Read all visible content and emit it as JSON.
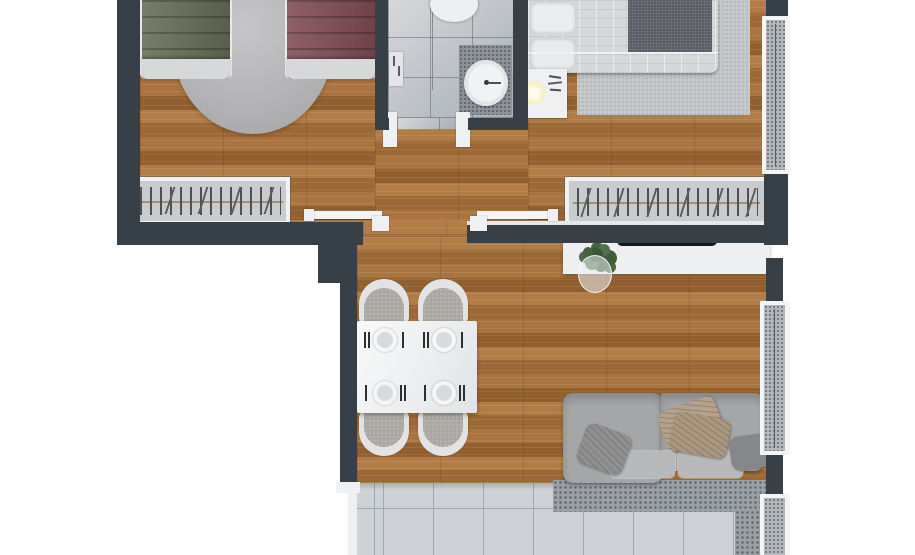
{
  "scene": {
    "type": "floor-plan-3d-top-view",
    "rooms": [
      {
        "name": "twin-bedroom",
        "position": "top-left"
      },
      {
        "name": "bathroom",
        "position": "top-center"
      },
      {
        "name": "master-bedroom",
        "position": "top-right"
      },
      {
        "name": "hallway",
        "position": "center"
      },
      {
        "name": "living-dining-room",
        "position": "bottom-center"
      },
      {
        "name": "tiled-balcony",
        "position": "bottom"
      }
    ],
    "furniture": [
      "single-bed-green",
      "single-bed-maroon",
      "round-rug",
      "wardrobe-twin",
      "toilet",
      "shower-screen",
      "washbasin",
      "double-bed",
      "nightstand",
      "table-lamp",
      "area-rug",
      "wardrobe-master",
      "sliding-door-left",
      "sliding-door-right",
      "dining-table",
      "dining-chairs-x4",
      "place-settings-x4",
      "tv-sideboard",
      "tv",
      "plant",
      "sofa",
      "sofa-cushions",
      "sofa-rug",
      "window-curtain-master",
      "window-curtain-living",
      "window-curtain-balcony"
    ],
    "visible_text": ""
  },
  "colors": {
    "wall": "#373f47",
    "wood": "#a6713d",
    "tile": "#ced2d7",
    "bath_tile": "#bcc0c5",
    "curtain": "#b4b8bc",
    "round_rug": "#b7b7b9",
    "master_rug": "#c7c8ca",
    "bed_green": "#656b55",
    "bed_maroon": "#7d4b52",
    "bed_master": "#d6d7d9",
    "throw_blanket": "#5a5e64",
    "sofa": "#a4a6a8",
    "seat_cushion": "#b7b9bb",
    "pillow_beige": "#b5a28d",
    "pillow_gray": "#8e9093",
    "table": "#f0f2f3",
    "console": "#edeff0",
    "tv": "#17181a",
    "plant": "#47623f",
    "lamp_glow": "#f7eec6",
    "white_trim": "#f0f1f3"
  }
}
